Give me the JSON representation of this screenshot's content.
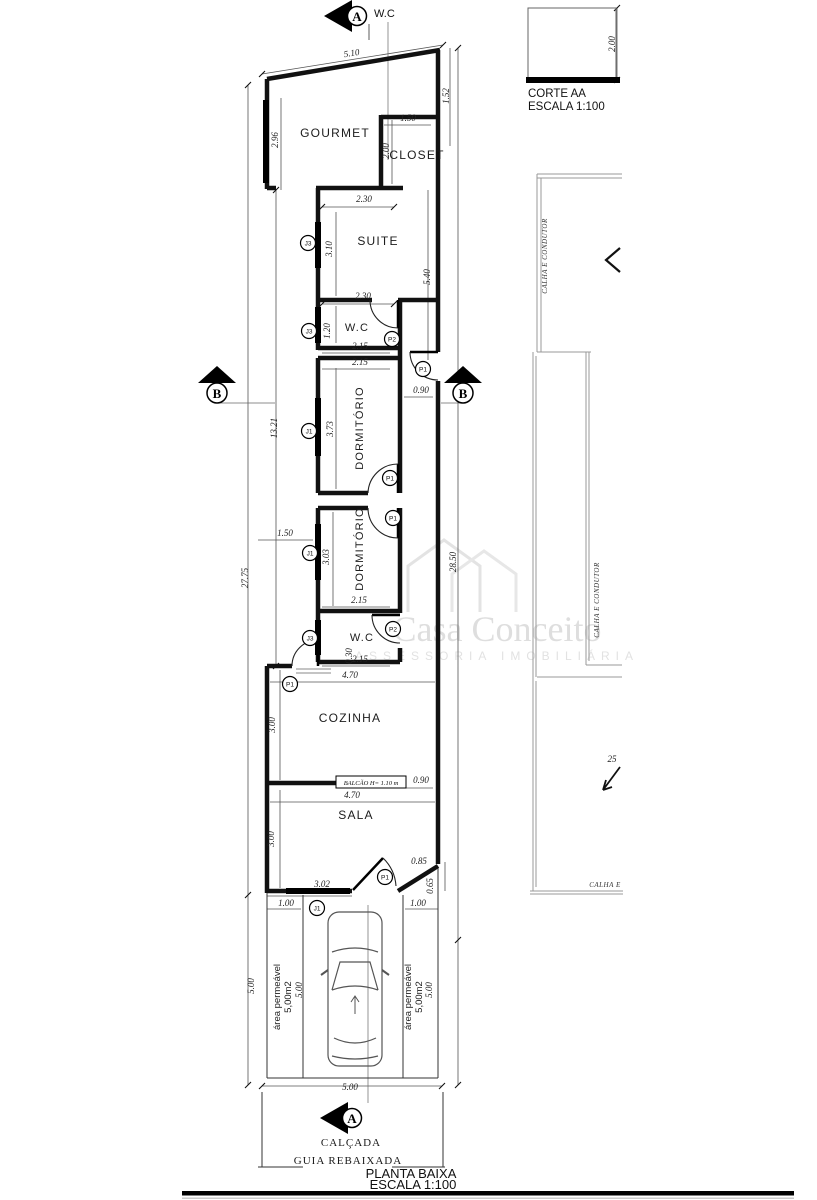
{
  "header": {
    "section_note": "W.C"
  },
  "corte": {
    "title": "CORTE AA",
    "scale": "ESCALA 1:100",
    "height_dim": "2.00"
  },
  "title_block": {
    "title": "PLANTA BAIXA",
    "scale": "ESCALA 1:100"
  },
  "site": {
    "calcada": "CALÇADA",
    "guia": "GUIA REBAIXADA",
    "area_permeavel_line1": "área permeável",
    "area_permeavel_line2": "5,00m2"
  },
  "roof": {
    "calha_top": "CALHA E CONDUTOR",
    "calha_mid": "CALHA E CONDUTOR",
    "calha_bottom": "CALHA E",
    "slope": "25"
  },
  "watermark": {
    "line1": "Casa Conceito",
    "line2": "ASSESSORIA IMOBILIÁRIA"
  },
  "plan": {
    "section_a": "A",
    "section_b": "B",
    "balcao_label": "BALCÃO H= 1.10 m",
    "rooms": [
      {
        "label": "GOURMET",
        "x": 335,
        "y": 137,
        "r": 0,
        "s": 12
      },
      {
        "label": "CLOSET",
        "x": 417,
        "y": 159,
        "r": 0,
        "s": 12
      },
      {
        "label": "SUITE",
        "x": 378,
        "y": 245,
        "r": 0,
        "s": 12
      },
      {
        "label": "W.C",
        "x": 357,
        "y": 331,
        "r": 0,
        "s": 11
      },
      {
        "label": "DORMITÓRIO",
        "x": 363,
        "y": 428,
        "r": -90,
        "s": 11
      },
      {
        "label": "DORMITÓRIO",
        "x": 363,
        "y": 549,
        "r": -90,
        "s": 11
      },
      {
        "label": "W.C",
        "x": 362,
        "y": 641,
        "r": 0,
        "s": 11
      },
      {
        "label": "COZINHA",
        "x": 350,
        "y": 722,
        "r": 0,
        "s": 12
      },
      {
        "label": "SALA",
        "x": 356,
        "y": 819,
        "r": 0,
        "s": 12
      }
    ],
    "dim_labels": [
      {
        "t": "5.10",
        "x": 352,
        "y": 56,
        "r": -9
      },
      {
        "t": "2.96",
        "x": 278,
        "y": 140,
        "r": -90
      },
      {
        "t": "1.52",
        "x": 449,
        "y": 96,
        "r": -90
      },
      {
        "t": "1.50",
        "x": 408,
        "y": 121,
        "r": 0
      },
      {
        "t": "2.00",
        "x": 389,
        "y": 151,
        "r": -90
      },
      {
        "t": "2.30",
        "x": 364,
        "y": 202,
        "r": 0
      },
      {
        "t": "3.10",
        "x": 332,
        "y": 249,
        "r": -90
      },
      {
        "t": "5.40",
        "x": 430,
        "y": 277,
        "r": -90
      },
      {
        "t": "2.30",
        "x": 363,
        "y": 299,
        "r": 0
      },
      {
        "t": "1.20",
        "x": 330,
        "y": 331,
        "r": -90
      },
      {
        "t": "2.15",
        "x": 360,
        "y": 349,
        "r": 0
      },
      {
        "t": "2.15",
        "x": 360,
        "y": 365,
        "r": 0
      },
      {
        "t": "0.90",
        "x": 421,
        "y": 393,
        "r": 0
      },
      {
        "t": "3.73",
        "x": 333,
        "y": 429,
        "r": -90
      },
      {
        "t": "13.21",
        "x": 277,
        "y": 428,
        "r": -90
      },
      {
        "t": "1.50",
        "x": 285,
        "y": 536,
        "r": 0
      },
      {
        "t": "3.03",
        "x": 329,
        "y": 557,
        "r": -90
      },
      {
        "t": "28.50",
        "x": 456,
        "y": 562,
        "r": -90
      },
      {
        "t": "27.75",
        "x": 248,
        "y": 578,
        "r": -90
      },
      {
        "t": "2.15",
        "x": 359,
        "y": 603,
        "r": 0
      },
      {
        "t": "0.30",
        "x": 352,
        "y": 656,
        "r": -90
      },
      {
        "t": "2.15",
        "x": 360,
        "y": 662,
        "r": 0
      },
      {
        "t": "4.70",
        "x": 350,
        "y": 678,
        "r": 0
      },
      {
        "t": "3.00",
        "x": 275,
        "y": 725,
        "r": -90
      },
      {
        "t": "0.90",
        "x": 421,
        "y": 783,
        "r": 0
      },
      {
        "t": "4.70",
        "x": 352,
        "y": 798,
        "r": 0
      },
      {
        "t": "3.00",
        "x": 274,
        "y": 839,
        "r": -90
      },
      {
        "t": "0.85",
        "x": 419,
        "y": 864,
        "r": 0
      },
      {
        "t": "3.02",
        "x": 322,
        "y": 887,
        "r": 0
      },
      {
        "t": "0.65",
        "x": 433,
        "y": 886,
        "r": -90
      },
      {
        "t": "1.00",
        "x": 286,
        "y": 906,
        "r": 0
      },
      {
        "t": "1.00",
        "x": 418,
        "y": 906,
        "r": 0
      },
      {
        "t": "5.00",
        "x": 254,
        "y": 986,
        "r": -90
      },
      {
        "t": "5.00",
        "x": 302,
        "y": 990,
        "r": -90
      },
      {
        "t": "5.00",
        "x": 432,
        "y": 990,
        "r": -90
      },
      {
        "t": "5.00",
        "x": 350,
        "y": 1090,
        "r": 0
      },
      {
        "t": "2.00",
        "x": 615,
        "y": 44,
        "r": -90
      }
    ],
    "markers": [
      {
        "t": "J3",
        "x": 308,
        "y": 243
      },
      {
        "t": "J3",
        "x": 309,
        "y": 331
      },
      {
        "t": "J1",
        "x": 309,
        "y": 431
      },
      {
        "t": "J1",
        "x": 310,
        "y": 553
      },
      {
        "t": "J3",
        "x": 310,
        "y": 638
      },
      {
        "t": "J1",
        "x": 317,
        "y": 908
      },
      {
        "t": "P2",
        "x": 392,
        "y": 339
      },
      {
        "t": "P1",
        "x": 423,
        "y": 369
      },
      {
        "t": "P1",
        "x": 390,
        "y": 478
      },
      {
        "t": "P1",
        "x": 393,
        "y": 518
      },
      {
        "t": "P2",
        "x": 393,
        "y": 629
      },
      {
        "t": "P1",
        "x": 290,
        "y": 684
      },
      {
        "t": "P1",
        "x": 385,
        "y": 877
      }
    ]
  }
}
